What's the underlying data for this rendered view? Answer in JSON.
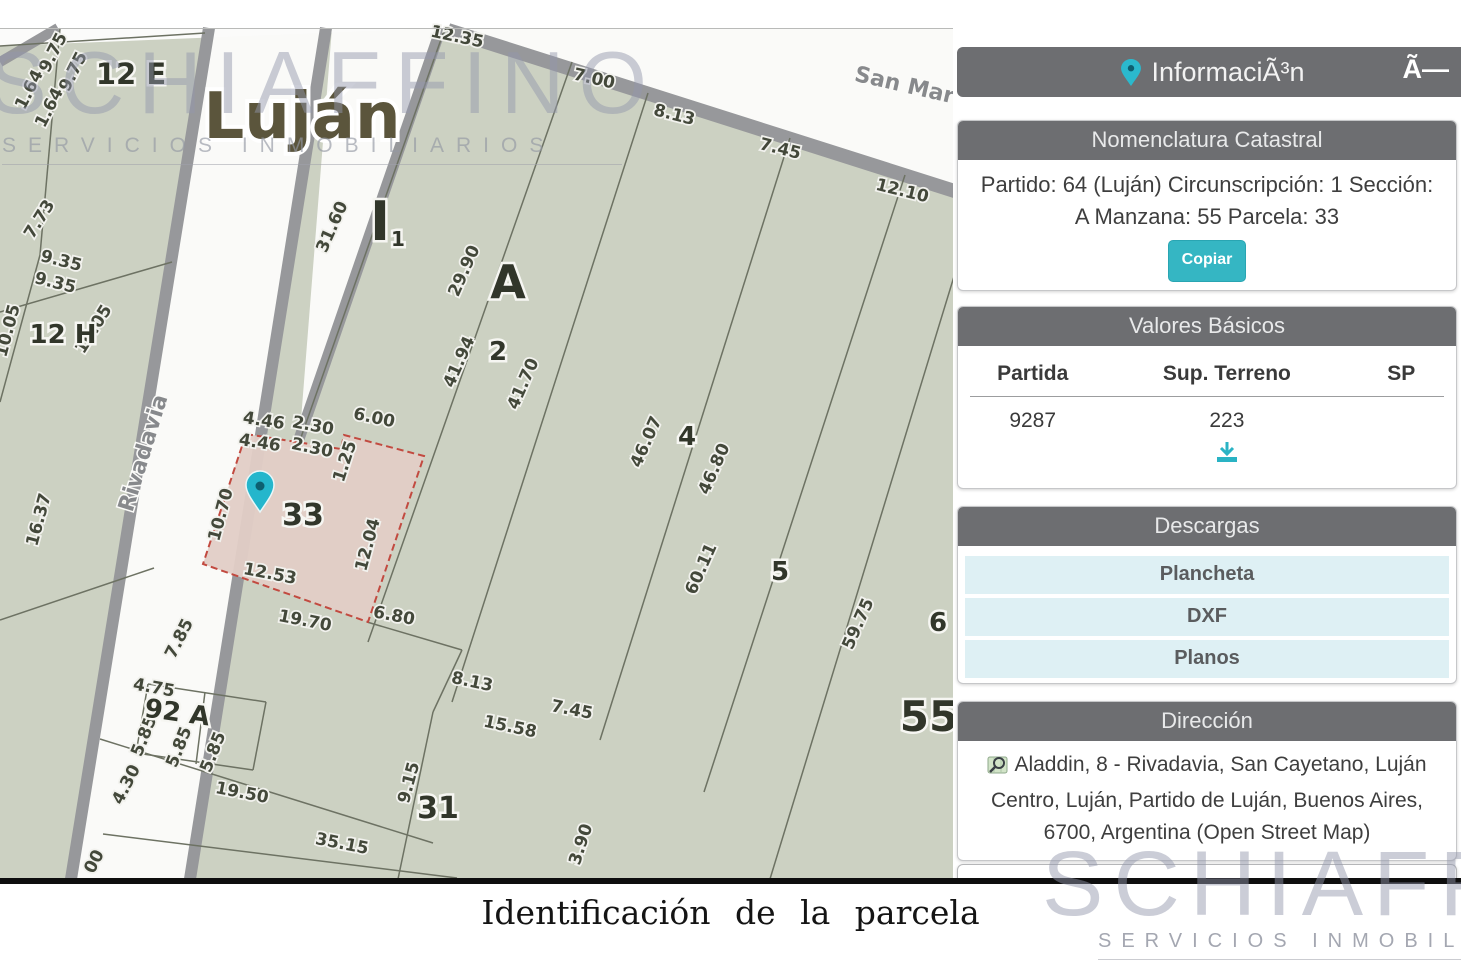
{
  "panel": {
    "header": {
      "title": "InformaciÃ³n",
      "close": "Ã—"
    },
    "nomenclatura": {
      "title": "Nomenclatura Catastral",
      "line1": "Partido: 64 (Luján) Circunscripción: 1 Sección:",
      "line2": "A Manzana: 55 Parcela: 33",
      "copy_label": "Copiar"
    },
    "valores": {
      "title": "Valores Básicos",
      "columns": [
        "Partida",
        "Sup. Terreno",
        "SP"
      ],
      "row": [
        "9287",
        "223",
        ""
      ]
    },
    "descargas": {
      "title": "Descargas",
      "items": [
        "Plancheta",
        "DXF",
        "Planos"
      ]
    },
    "direccion": {
      "title": "Dirección",
      "text": "Aladdin, 8 - Rivadavia, San Cayetano, Luján Centro, Luján, Partido de Luján, Buenos Aires, 6700, Argentina (Open Street Map)"
    }
  },
  "caption": "Identificación  de la parcela",
  "watermark": {
    "name": "SCHIAFFINO",
    "subtitle": "SERVICIOS INMOBILIARIOS"
  },
  "colors": {
    "accent_teal": "#35b6c3",
    "panel_gray": "#6d6e71",
    "map_bg": "#ccd1c2",
    "parcel_fill": "#e2cdc6",
    "parcel_border": "#c24a40",
    "row_blue": "#def0f4"
  },
  "map": {
    "city_label": {
      "t": "Luján",
      "x": 302,
      "y": 138
    },
    "selected_parcel": {
      "label": "33",
      "points": "246,434 341,449 344,435 424,456 368,622 203,564"
    },
    "pin": {
      "x": 260,
      "y": 512
    },
    "street_labels": [
      {
        "t": "Rivadavia",
        "x": 150,
        "y": 455,
        "r": -73
      },
      {
        "t": "San Mar",
        "x": 903,
        "y": 92,
        "r": 13
      }
    ],
    "block_labels": [
      {
        "t": "12 E",
        "x": 131,
        "y": 84,
        "s": 29
      },
      {
        "t": "12 H",
        "x": 63,
        "y": 343,
        "s": 26
      },
      {
        "t": "A",
        "x": 508,
        "y": 298,
        "s": 46
      },
      {
        "t": "2",
        "x": 498,
        "y": 360,
        "s": 26
      },
      {
        "t": "4",
        "x": 687,
        "y": 445,
        "s": 26
      },
      {
        "t": "5",
        "x": 780,
        "y": 580,
        "s": 26
      },
      {
        "t": "6",
        "x": 938,
        "y": 631,
        "s": 26
      },
      {
        "t": "33",
        "x": 303,
        "y": 525,
        "s": 30
      },
      {
        "t": "31",
        "x": 438,
        "y": 818,
        "s": 30
      },
      {
        "t": "55",
        "x": 929,
        "y": 731,
        "s": 42
      },
      {
        "t": "92 A",
        "x": 176,
        "y": 721,
        "s": 26,
        "r": 8
      },
      {
        "t": "I",
        "x": 380,
        "y": 240,
        "s": 54
      },
      {
        "t": "1",
        "x": 398,
        "y": 246,
        "s": 20
      }
    ],
    "measurements": [
      {
        "t": "12.35",
        "x": 456,
        "y": 42,
        "r": 12
      },
      {
        "t": "7.00",
        "x": 593,
        "y": 84,
        "r": 13
      },
      {
        "t": "8.13",
        "x": 673,
        "y": 120,
        "r": 14
      },
      {
        "t": "7.45",
        "x": 779,
        "y": 154,
        "r": 14
      },
      {
        "t": "12.10",
        "x": 901,
        "y": 196,
        "r": 14
      },
      {
        "t": "9.75",
        "x": 58,
        "y": 55,
        "r": -63
      },
      {
        "t": "9.75",
        "x": 78,
        "y": 74,
        "r": -63
      },
      {
        "t": "1.64",
        "x": 34,
        "y": 92,
        "r": -63
      },
      {
        "t": "1.64",
        "x": 54,
        "y": 110,
        "r": -63
      },
      {
        "t": "7.73",
        "x": 44,
        "y": 222,
        "r": -58
      },
      {
        "t": "9.35",
        "x": 60,
        "y": 266,
        "r": 14
      },
      {
        "t": "9.35",
        "x": 54,
        "y": 288,
        "r": 14
      },
      {
        "t": "10.05",
        "x": 13,
        "y": 332,
        "r": -75
      },
      {
        "t": "10.05",
        "x": 98,
        "y": 332,
        "r": -58
      },
      {
        "t": "16.37",
        "x": 44,
        "y": 521,
        "r": -75
      },
      {
        "t": "31.60",
        "x": 337,
        "y": 229,
        "r": -66
      },
      {
        "t": "29.90",
        "x": 469,
        "y": 273,
        "r": -66
      },
      {
        "t": "41.94",
        "x": 464,
        "y": 364,
        "r": -66
      },
      {
        "t": "41.70",
        "x": 528,
        "y": 386,
        "r": -66
      },
      {
        "t": "46.07",
        "x": 651,
        "y": 444,
        "r": -66
      },
      {
        "t": "46.80",
        "x": 719,
        "y": 471,
        "r": -66
      },
      {
        "t": "60.11",
        "x": 706,
        "y": 571,
        "r": -66
      },
      {
        "t": "59.75",
        "x": 863,
        "y": 626,
        "r": -66
      },
      {
        "t": "4.46",
        "x": 263,
        "y": 426,
        "r": 9
      },
      {
        "t": "2.30",
        "x": 312,
        "y": 431,
        "r": 11
      },
      {
        "t": "6.00",
        "x": 373,
        "y": 423,
        "r": 12
      },
      {
        "t": "4.46",
        "x": 259,
        "y": 448,
        "r": 9
      },
      {
        "t": "2.30",
        "x": 311,
        "y": 453,
        "r": 12
      },
      {
        "t": "1.25",
        "x": 350,
        "y": 463,
        "r": -72
      },
      {
        "t": "10.70",
        "x": 226,
        "y": 516,
        "r": -75
      },
      {
        "t": "12.04",
        "x": 373,
        "y": 546,
        "r": -75
      },
      {
        "t": "12.53",
        "x": 269,
        "y": 579,
        "r": 11
      },
      {
        "t": "19.70",
        "x": 304,
        "y": 626,
        "r": 11
      },
      {
        "t": "6.80",
        "x": 393,
        "y": 621,
        "r": 11
      },
      {
        "t": "7.85",
        "x": 184,
        "y": 641,
        "r": -63
      },
      {
        "t": "4.75",
        "x": 153,
        "y": 693,
        "r": 10
      },
      {
        "t": "5.85",
        "x": 149,
        "y": 738,
        "r": -68
      },
      {
        "t": "5.85",
        "x": 184,
        "y": 749,
        "r": -68
      },
      {
        "t": "5.85",
        "x": 218,
        "y": 754,
        "r": -68
      },
      {
        "t": "4.30",
        "x": 131,
        "y": 787,
        "r": -63
      },
      {
        "t": "19.50",
        "x": 241,
        "y": 798,
        "r": 11
      },
      {
        "t": "35.15",
        "x": 341,
        "y": 849,
        "r": 11
      },
      {
        "t": "9.15",
        "x": 414,
        "y": 784,
        "r": -75
      },
      {
        "t": "8.13",
        "x": 471,
        "y": 687,
        "r": 12
      },
      {
        "t": "15.58",
        "x": 509,
        "y": 732,
        "r": 12
      },
      {
        "t": "7.45",
        "x": 571,
        "y": 715,
        "r": 11
      },
      {
        "t": "3.90",
        "x": 586,
        "y": 846,
        "r": -72
      },
      {
        "t": "00",
        "x": 99,
        "y": 864,
        "r": -63
      }
    ],
    "lines": [
      [
        0,
        46,
        205,
        33
      ],
      [
        60,
        28,
        40,
        255
      ],
      [
        40,
        255,
        0,
        402
      ],
      [
        0,
        312,
        172,
        262
      ],
      [
        0,
        620,
        154,
        568
      ],
      [
        445,
        28,
        299,
        443
      ],
      [
        572,
        62,
        368,
        642
      ],
      [
        648,
        93,
        452,
        702
      ],
      [
        790,
        138,
        600,
        740
      ],
      [
        905,
        175,
        704,
        792
      ],
      [
        963,
        247,
        770,
        879
      ],
      [
        367,
        622,
        462,
        650
      ],
      [
        462,
        650,
        433,
        712
      ],
      [
        433,
        712,
        398,
        879
      ],
      [
        100,
        739,
        433,
        843
      ],
      [
        103,
        834,
        457,
        878
      ],
      [
        148,
        684,
        266,
        702
      ],
      [
        266,
        702,
        253,
        770
      ],
      [
        253,
        770,
        136,
        753
      ],
      [
        136,
        753,
        148,
        684
      ],
      [
        205,
        692,
        196,
        764
      ]
    ]
  }
}
